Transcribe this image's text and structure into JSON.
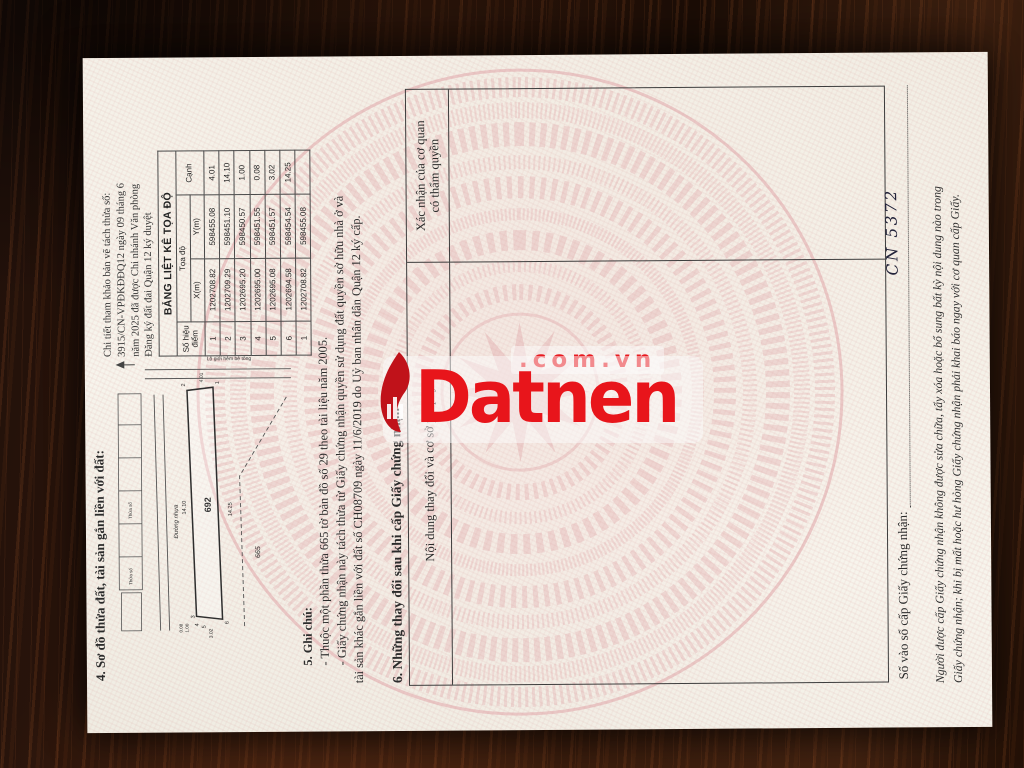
{
  "colors": {
    "watermark_red": "#e8191f",
    "pattern_pink": "#e5b9b9",
    "wood_brown": "#34190c"
  },
  "watermark": {
    "brand": "Datnen",
    "suffix": ".com.vn"
  },
  "page": {
    "section4": {
      "title": "4. Sơ đồ thửa đất, tài sản gắn liền với đất:"
    },
    "citation": {
      "lines": [
        "Chi tiết tham khảo bản vẽ tách thửa số:",
        "3915/CN-VPĐKĐĐQ12 ngày 09 tháng 6",
        "năm 2025 đã được Chi nhánh Văn phòng",
        "Đăng ký đất đai Quận 12 ký duyệt"
      ]
    },
    "coord_table": {
      "title": "BẢNG LIỆT KÊ TỌA ĐỘ",
      "col_point_l1": "Số hiệu",
      "col_point_l2": "điểm",
      "col_coords": "Tọa độ",
      "col_x": "X(m)",
      "col_y": "Y(m)",
      "col_edge": "Cạnh",
      "rows": [
        [
          "1",
          "1202708.82",
          "598455.08",
          "4.01"
        ],
        [
          "2",
          "1202709.29",
          "598451.10",
          "14.10"
        ],
        [
          "3",
          "1202695.20",
          "598450.57",
          "1.00"
        ],
        [
          "4",
          "1202695.00",
          "598451.55",
          "0.08"
        ],
        [
          "5",
          "1202695.08",
          "598451.57",
          "3.02"
        ],
        [
          "6",
          "1202694.58",
          "598454.54",
          "14.25"
        ],
        [
          "1",
          "1202708.82",
          "598455.08",
          ""
        ]
      ]
    },
    "drawing": {
      "parcel_number": "692",
      "origin_parcel": "665",
      "road_label": "Đường nhựa",
      "alley_label": "Lộ giới hẻm bê tông",
      "neighbor_label": "Thửa số",
      "dim_top": "14.10",
      "dim_bottom": "14.25",
      "dim_right": "4.01",
      "dim_left": "3.02",
      "dim_c1": "1.00",
      "dim_c2": "0.08",
      "points": [
        "1",
        "2",
        "3",
        "4",
        "5",
        "6"
      ]
    },
    "section5": {
      "title": "5. Ghi chú:",
      "lines": [
        "- Thuộc một phần thửa 665 tờ bản đồ số 29 theo tài liệu năm 2005.",
        "- Giấy chứng nhận này tách thửa từ Giấy chứng nhận quyền sử dụng đất quyền sở hữu nhà ở và",
        "tài sản khác gắn liền với đất số CH08709 ngày 11/6/2019 do Uỷ ban nhân dân Quận 12 ký cấp."
      ]
    },
    "section6": {
      "title": "6. Những thay đổi sau khi cấp Giấy chứng nhận",
      "col_left": "Nội dung thay đổi và cơ sở pháp lý",
      "col_right_l1": "Xác nhận của cơ quan",
      "col_right_l2": "có thẩm quyền"
    },
    "footer": {
      "register_label": "Số vào sổ cấp Giấy chứng nhận:",
      "register_value": "CN 5372",
      "fine_print_1": "Người được cấp Giấy chứng nhận không được sửa chữa, tẩy xóa hoặc bổ sung bất kỳ nội dung nào trong",
      "fine_print_2": "Giấy chứng nhận; khi bị mất hoặc hư hỏng Giấy chứng nhận phải khai báo ngay với cơ quan cấp Giấy."
    }
  }
}
